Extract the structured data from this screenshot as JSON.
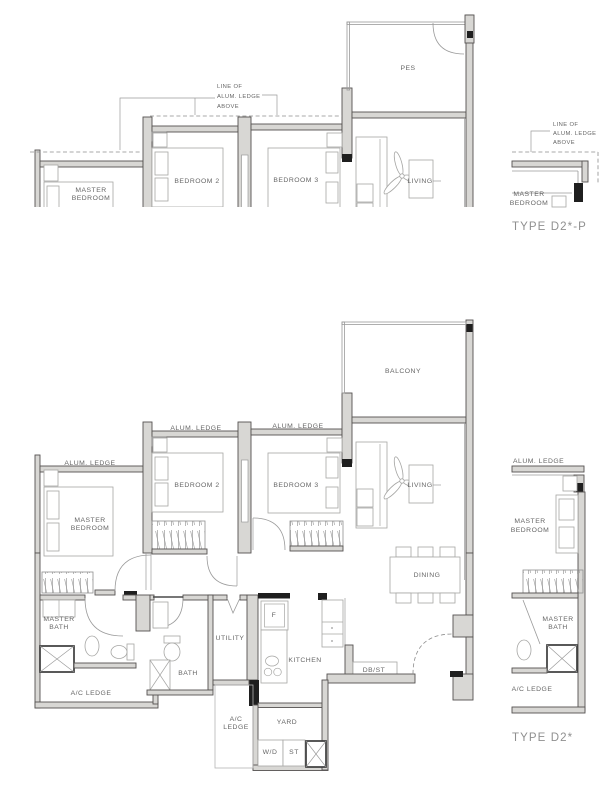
{
  "sheet": {
    "kind": "floor-plan-drawing"
  },
  "colors": {
    "background": "#ffffff",
    "wall_fill": "#d8d7d4",
    "wall_outline": "#555250",
    "solid_black": "#1f1f1f",
    "drawing_line": "#9a9a9a",
    "label_text": "#666666",
    "type_text": "#8f8f8f"
  },
  "top_plan": {
    "ledge_note": [
      "LINE OF",
      "ALUM. LEDGE",
      "ABOVE"
    ],
    "rooms": {
      "pes": "PES",
      "master_bedroom": [
        "MASTER",
        "BEDROOM"
      ],
      "bedroom2": "BEDROOM 2",
      "bedroom3": "BEDROOM 3",
      "living": "LIVING"
    },
    "mini": {
      "ledge_note": [
        "LINE OF",
        "ALUM. LEDGE",
        "ABOVE"
      ],
      "master_bedroom": [
        "MASTER",
        "BEDROOM"
      ],
      "type_label": "TYPE D2*-P"
    }
  },
  "bottom_plan": {
    "ledge_labels": {
      "master": "ALUM. LEDGE",
      "bedroom2": "ALUM. LEDGE",
      "bedroom3": "ALUM. LEDGE"
    },
    "rooms": {
      "balcony": "BALCONY",
      "living": "LIVING",
      "dining": "DINING",
      "master_bedroom": [
        "MASTER",
        "BEDROOM"
      ],
      "bedroom2": "BEDROOM 2",
      "bedroom3": "BEDROOM 3",
      "master_bath": [
        "MASTER",
        "BATH"
      ],
      "bath": "BATH",
      "utility": "UTILITY",
      "kitchen": "KITCHEN",
      "fridge": "F",
      "db_st": "DB/ST",
      "yard": "YARD",
      "washer_dryer": "W/D",
      "store": "ST",
      "ac_ledge_left": "A/C LEDGE",
      "ac_ledge_mid": [
        "A/C",
        "LEDGE"
      ]
    },
    "mini": {
      "alum_ledge": "ALUM. LEDGE",
      "master_bedroom": [
        "MASTER",
        "BEDROOM"
      ],
      "master_bath": [
        "MASTER",
        "BATH"
      ],
      "ac_ledge": "A/C LEDGE",
      "type_label": "TYPE D2*"
    }
  }
}
